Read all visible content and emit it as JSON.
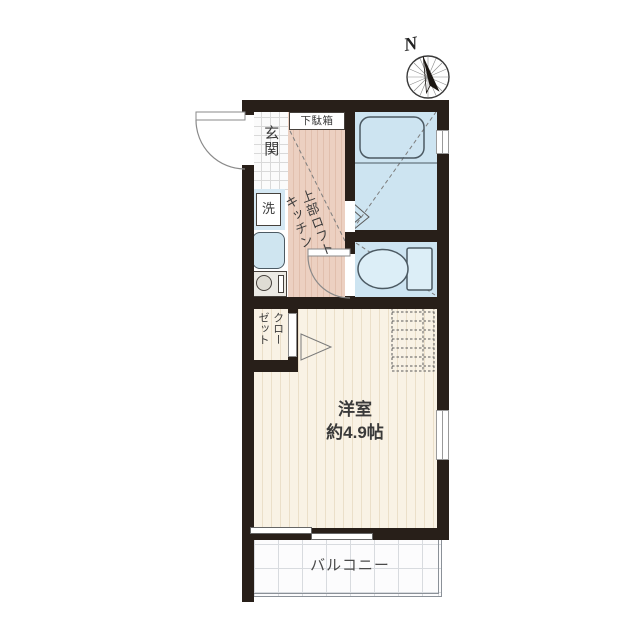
{
  "compass": {
    "north_label": "N"
  },
  "plan": {
    "entrance_label": "玄関",
    "shoe_cabinet_label": "下駄箱",
    "washer_label": "洗",
    "kitchen_label_col1": "上部ロフト",
    "kitchen_label_col2": "キッチン",
    "closet_label_col1": "クロー",
    "closet_label_col2": "ゼット",
    "room_label": "洋室",
    "room_size_label": "約4.9帖",
    "balcony_label": "バルコニー"
  },
  "colors": {
    "wall": "#281f19",
    "water_rooms": "#cde4f1",
    "kitchen_floor": "#ecd0c1",
    "room_floor": "#f9f2e5",
    "fixture_outline": "#4c5a63"
  }
}
